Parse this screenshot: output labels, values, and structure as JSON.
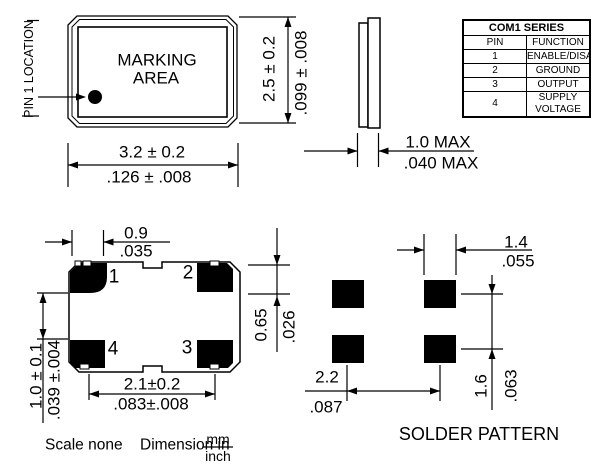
{
  "top_view": {
    "pin1_label": "PIN 1 LOCATION",
    "marking_line1": "MARKING",
    "marking_line2": "AREA",
    "width_mm": "3.2 ± 0.2",
    "width_in": ".126 ± .008",
    "height_mm": "2.5 ± 0.2",
    "height_in": ".099 ± .008"
  },
  "side_view": {
    "thickness_mm": "1.0 MAX",
    "thickness_in": ".040 MAX"
  },
  "pin_table": {
    "title": "COM1 SERIES",
    "col1": "PIN",
    "col2": "FUNCTION",
    "rows": [
      {
        "pin": "1",
        "function": "ENABLE/DISABLE"
      },
      {
        "pin": "2",
        "function": "GROUND"
      },
      {
        "pin": "3",
        "function": "OUTPUT"
      },
      {
        "pin": "4",
        "function": "SUPPLY VOLTAGE"
      }
    ]
  },
  "bottom_view": {
    "pads": {
      "p1": "1",
      "p2": "2",
      "p3": "3",
      "p4": "4"
    },
    "pad_width_mm": "0.9",
    "pad_width_in": ".035",
    "pad_height_mm": "0.65",
    "pad_height_in": ".026",
    "row_gap_mm": "1.0 ± 0.1",
    "row_gap_in": ".039 ±.004",
    "pad_pitch_mm": "2.1±0.2",
    "pad_pitch_in": ".083±.008"
  },
  "solder_pattern": {
    "title": "SOLDER PATTERN",
    "pad_width_mm": "1.4",
    "pad_width_in": ".055",
    "row_pitch_mm": "1.6",
    "row_pitch_in": ".063",
    "col_pitch_mm": "2.2",
    "col_pitch_in": ".087"
  },
  "footer": {
    "scale": "Scale none",
    "dimension": "Dimension in",
    "unit_top": "mm",
    "unit_bottom": "inch"
  },
  "colors": {
    "ink": "#000000",
    "paper": "#ffffff"
  }
}
